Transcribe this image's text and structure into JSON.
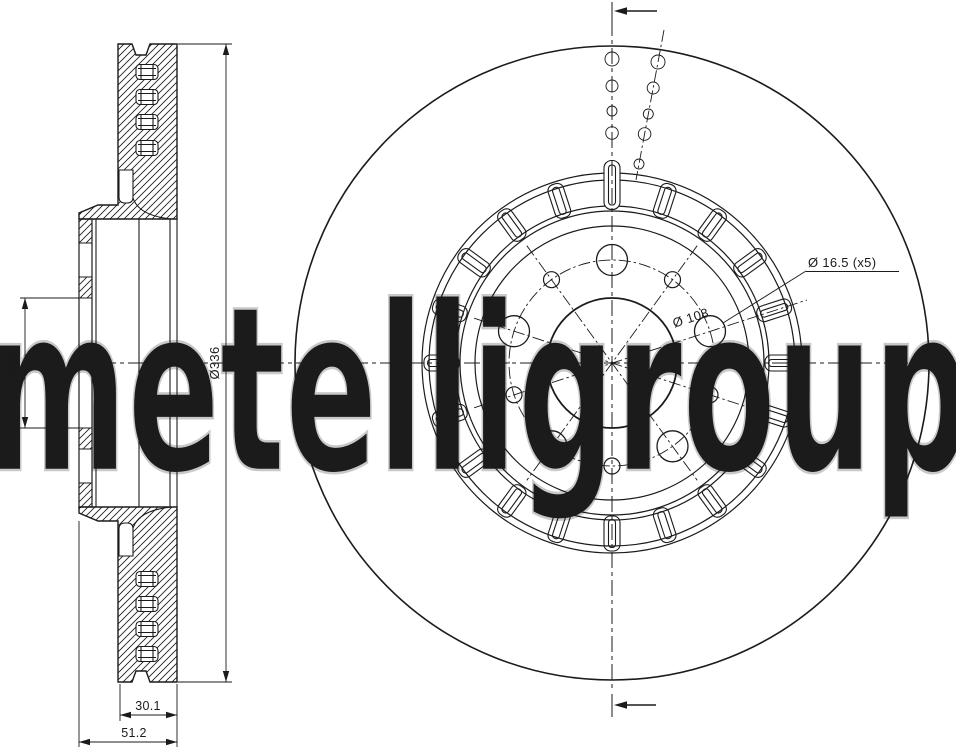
{
  "watermark": {
    "text": "metelligroup",
    "color": "#c9c9c9"
  },
  "drawing": {
    "subject": "vented brake disc technical drawing",
    "views": {
      "left": "cross-section view",
      "right": "front view"
    }
  },
  "dimensions": {
    "bore_diameter": "Ø68",
    "outer_diameter": "Ø336",
    "thickness": "30.1",
    "overall_height": "51.2",
    "bolt_holes": "Ø 16.5 (x5)",
    "pitch_circle": "Ø 108"
  },
  "front_view": {
    "vent_slot_count": 20,
    "bolt_hole_count": 5,
    "intermediate_hole_count": 5
  },
  "style": {
    "line_color": "#1b1b1b",
    "background": "#ffffff"
  }
}
